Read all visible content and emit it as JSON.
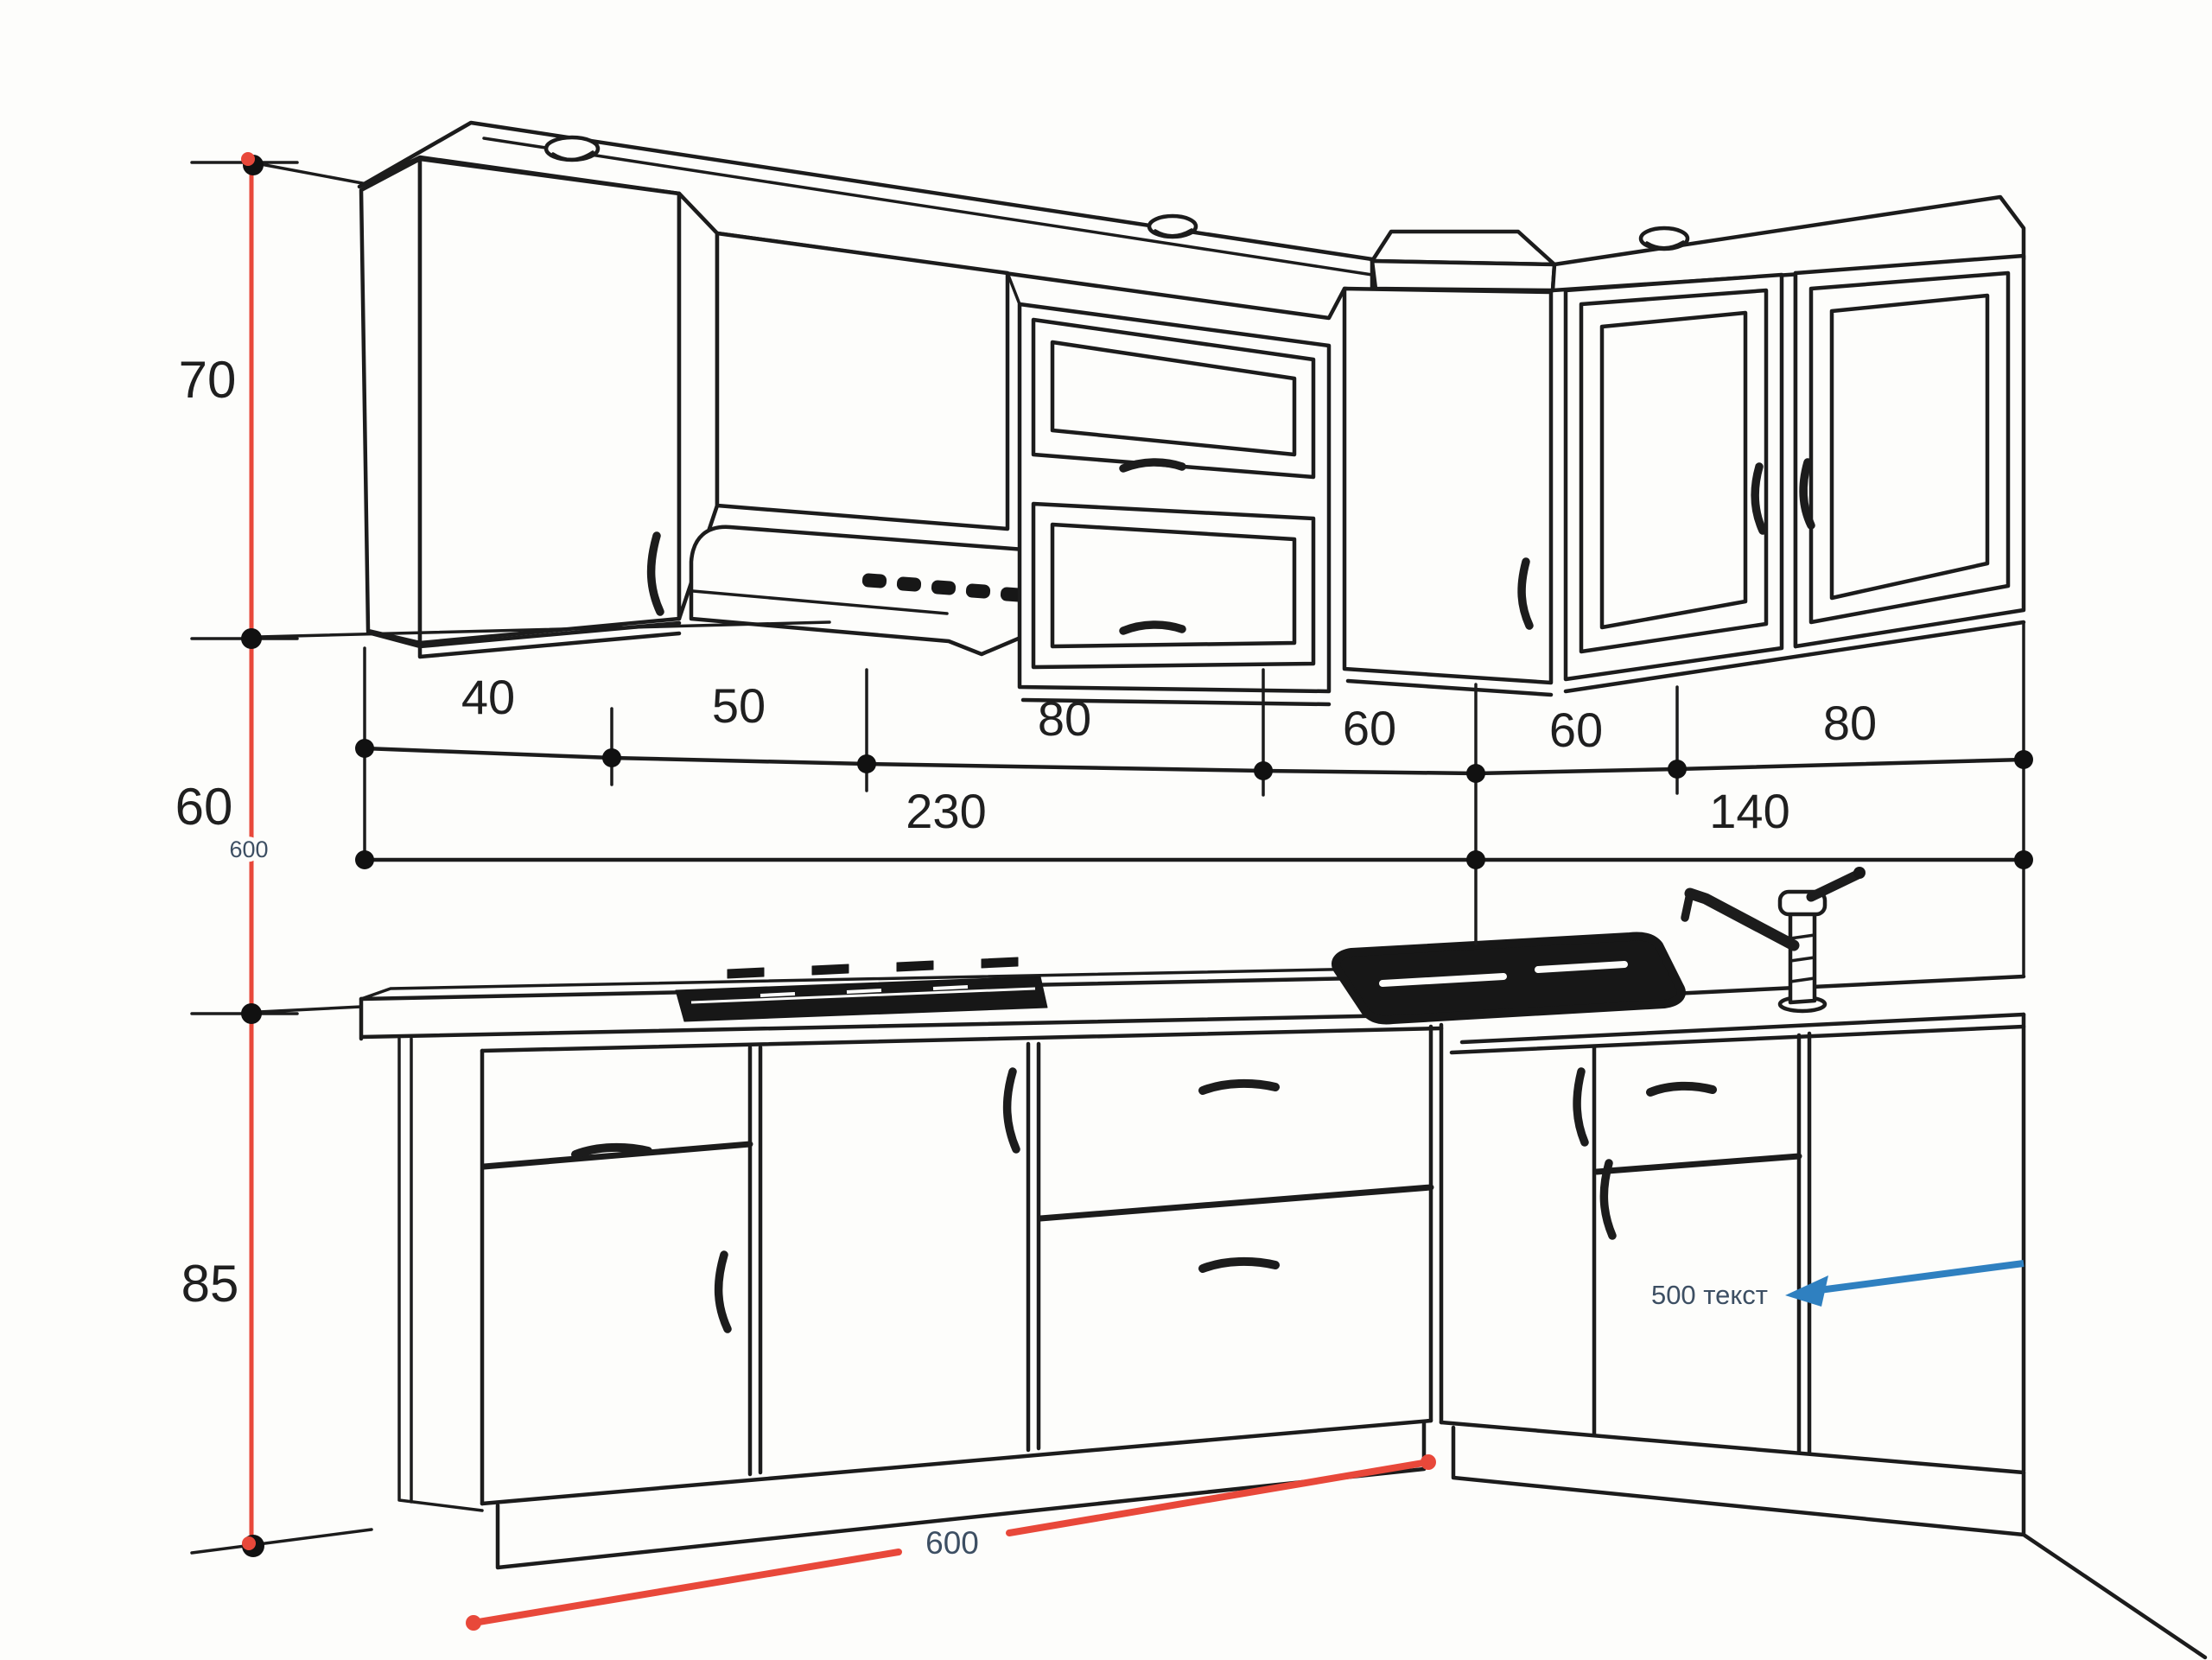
{
  "drawing": {
    "title_semantic": "corner-kitchen-cabinet-dimension-drawing",
    "colors": {
      "background": "#fdfdfb",
      "line_ink": "#1c1c1c",
      "dimension_red": "#e8483a",
      "arrow_blue": "#2f80c0",
      "annotation_slate": "#3d4f63",
      "dot_black": "#111111"
    }
  },
  "dimensions": {
    "vertical_left": {
      "upper": "70",
      "middle": "60",
      "lower": "85",
      "overall_small": "600"
    },
    "row1": [
      "40",
      "50",
      "80",
      "60",
      "60",
      "80"
    ],
    "row2": [
      "230",
      "140"
    ],
    "bottom_red_length": "600",
    "right_note": "500 текст"
  }
}
